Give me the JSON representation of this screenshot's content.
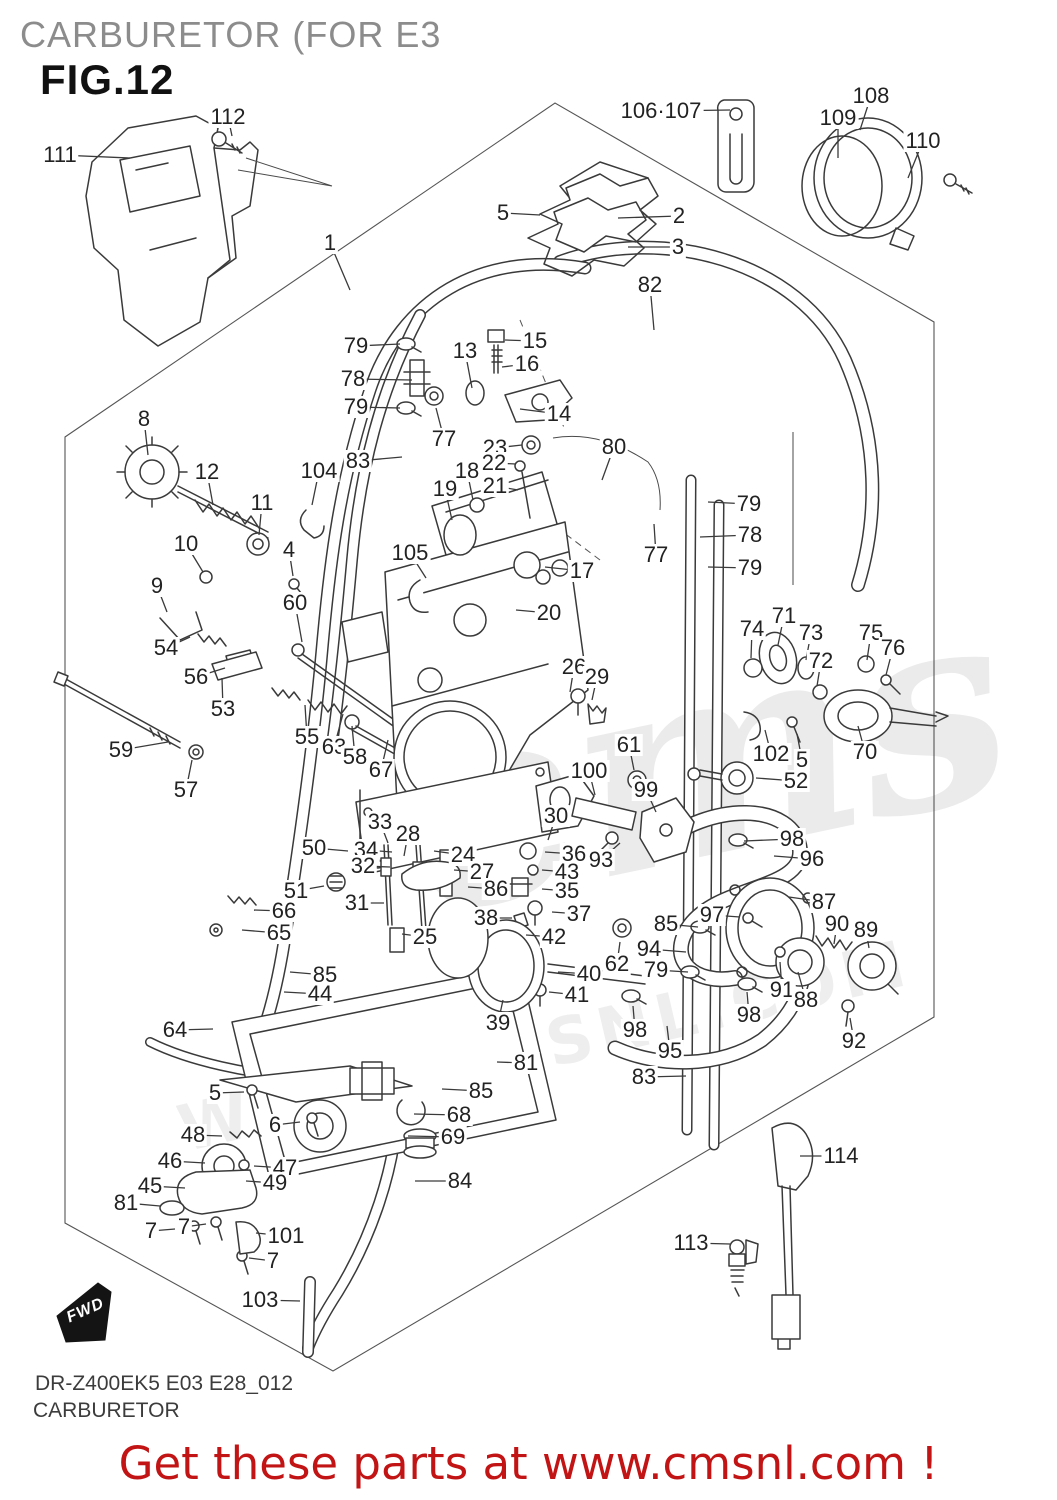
{
  "header": {
    "title": "CARBURETOR (FOR E3",
    "fig": "FIG.12"
  },
  "footer": {
    "model_code": "DR-Z400EK5 E03 E28_012",
    "sheet_name": "CARBURETOR",
    "promo": "Get these parts at www.cmsnl.com !"
  },
  "fwd": {
    "label": "FWD"
  },
  "watermark": {
    "logo": "ems",
    "url": "WWW.CMSNL.COM"
  },
  "colors": {
    "promo_red": "#c21414",
    "line": "#3a3a3a",
    "title_gray": "#8c8c8c"
  },
  "callouts": [
    {
      "n": "111",
      "x": 60,
      "y": 155,
      "lx": 130,
      "ly": 158
    },
    {
      "n": "112",
      "x": 228,
      "y": 117,
      "lx": 232,
      "ly": 136
    },
    {
      "n": "1",
      "x": 330,
      "y": 243,
      "lx": 350,
      "ly": 290
    },
    {
      "n": "5",
      "x": 503,
      "y": 213,
      "lx": 540,
      "ly": 215
    },
    {
      "n": "2",
      "x": 679,
      "y": 216,
      "lx": 618,
      "ly": 218
    },
    {
      "n": "3",
      "x": 678,
      "y": 247,
      "lx": 628,
      "ly": 247
    },
    {
      "n": "106·107",
      "x": 661,
      "y": 111,
      "lx": 730,
      "ly": 110
    },
    {
      "n": "108",
      "x": 871,
      "y": 96,
      "lx": 860,
      "ly": 130
    },
    {
      "n": "109",
      "x": 838,
      "y": 118,
      "lx": 838,
      "ly": 158
    },
    {
      "n": "110",
      "x": 923,
      "y": 141,
      "lx": 908,
      "ly": 178
    },
    {
      "n": "82",
      "x": 650,
      "y": 285,
      "lx": 654,
      "ly": 330
    },
    {
      "n": "79",
      "x": 356,
      "y": 346,
      "lx": 400,
      "ly": 344
    },
    {
      "n": "78",
      "x": 353,
      "y": 379,
      "lx": 412,
      "ly": 380
    },
    {
      "n": "79",
      "x": 356,
      "y": 407,
      "lx": 400,
      "ly": 408
    },
    {
      "n": "77",
      "x": 444,
      "y": 439,
      "lx": 436,
      "ly": 408
    },
    {
      "n": "13",
      "x": 465,
      "y": 351,
      "lx": 472,
      "ly": 388
    },
    {
      "n": "15",
      "x": 535,
      "y": 341,
      "lx": 505,
      "ly": 340
    },
    {
      "n": "16",
      "x": 527,
      "y": 364,
      "lx": 502,
      "ly": 367
    },
    {
      "n": "14",
      "x": 559,
      "y": 414,
      "lx": 520,
      "ly": 409
    },
    {
      "n": "83",
      "x": 358,
      "y": 461,
      "lx": 402,
      "ly": 457
    },
    {
      "n": "8",
      "x": 144,
      "y": 419,
      "lx": 148,
      "ly": 455
    },
    {
      "n": "12",
      "x": 207,
      "y": 472,
      "lx": 213,
      "ly": 505
    },
    {
      "n": "11",
      "x": 262,
      "y": 503,
      "lx": 259,
      "ly": 535
    },
    {
      "n": "104",
      "x": 319,
      "y": 471,
      "lx": 312,
      "ly": 505
    },
    {
      "n": "23",
      "x": 495,
      "y": 448,
      "lx": 522,
      "ly": 445
    },
    {
      "n": "22",
      "x": 494,
      "y": 463,
      "lx": 516,
      "ly": 464
    },
    {
      "n": "21",
      "x": 495,
      "y": 486,
      "lx": 518,
      "ly": 490
    },
    {
      "n": "18",
      "x": 467,
      "y": 471,
      "lx": 473,
      "ly": 500
    },
    {
      "n": "19",
      "x": 445,
      "y": 489,
      "lx": 452,
      "ly": 520
    },
    {
      "n": "80",
      "x": 614,
      "y": 447,
      "lx": 602,
      "ly": 480
    },
    {
      "n": "79",
      "x": 749,
      "y": 504,
      "lx": 708,
      "ly": 502
    },
    {
      "n": "78",
      "x": 750,
      "y": 535,
      "lx": 700,
      "ly": 537
    },
    {
      "n": "79",
      "x": 750,
      "y": 568,
      "lx": 708,
      "ly": 567
    },
    {
      "n": "77",
      "x": 656,
      "y": 555,
      "lx": 654,
      "ly": 524
    },
    {
      "n": "10",
      "x": 186,
      "y": 544,
      "lx": 203,
      "ly": 572
    },
    {
      "n": "4",
      "x": 289,
      "y": 550,
      "lx": 293,
      "ly": 576
    },
    {
      "n": "105",
      "x": 410,
      "y": 553,
      "lx": 426,
      "ly": 578
    },
    {
      "n": "9",
      "x": 157,
      "y": 586,
      "lx": 167,
      "ly": 612
    },
    {
      "n": "60",
      "x": 295,
      "y": 603,
      "lx": 302,
      "ly": 642
    },
    {
      "n": "17",
      "x": 582,
      "y": 571,
      "lx": 545,
      "ly": 567
    },
    {
      "n": "20",
      "x": 549,
      "y": 613,
      "lx": 516,
      "ly": 610
    },
    {
      "n": "54",
      "x": 166,
      "y": 648,
      "lx": 190,
      "ly": 637
    },
    {
      "n": "56",
      "x": 196,
      "y": 677,
      "lx": 225,
      "ly": 668
    },
    {
      "n": "53",
      "x": 223,
      "y": 709,
      "lx": 222,
      "ly": 678
    },
    {
      "n": "26",
      "x": 574,
      "y": 667,
      "lx": 570,
      "ly": 692
    },
    {
      "n": "29",
      "x": 597,
      "y": 677,
      "lx": 592,
      "ly": 700
    },
    {
      "n": "74",
      "x": 752,
      "y": 629,
      "lx": 751,
      "ly": 658
    },
    {
      "n": "71",
      "x": 784,
      "y": 616,
      "lx": 778,
      "ly": 645
    },
    {
      "n": "73",
      "x": 811,
      "y": 633,
      "lx": 806,
      "ly": 660
    },
    {
      "n": "72",
      "x": 821,
      "y": 661,
      "lx": 817,
      "ly": 686
    },
    {
      "n": "75",
      "x": 871,
      "y": 633,
      "lx": 867,
      "ly": 660
    },
    {
      "n": "76",
      "x": 893,
      "y": 648,
      "lx": 886,
      "ly": 675
    },
    {
      "n": "59",
      "x": 121,
      "y": 750,
      "lx": 168,
      "ly": 742
    },
    {
      "n": "57",
      "x": 186,
      "y": 790,
      "lx": 192,
      "ly": 760
    },
    {
      "n": "55",
      "x": 307,
      "y": 737,
      "lx": 305,
      "ly": 705
    },
    {
      "n": "63",
      "x": 334,
      "y": 747,
      "lx": 343,
      "ly": 714
    },
    {
      "n": "58",
      "x": 355,
      "y": 757,
      "lx": 352,
      "ly": 726
    },
    {
      "n": "67",
      "x": 381,
      "y": 770,
      "lx": 388,
      "ly": 740
    },
    {
      "n": "61",
      "x": 629,
      "y": 745,
      "lx": 634,
      "ly": 770
    },
    {
      "n": "100",
      "x": 589,
      "y": 771,
      "lx": 595,
      "ly": 795
    },
    {
      "n": "99",
      "x": 646,
      "y": 790,
      "lx": 656,
      "ly": 812
    },
    {
      "n": "102",
      "x": 771,
      "y": 754,
      "lx": 765,
      "ly": 730
    },
    {
      "n": "5",
      "x": 802,
      "y": 760,
      "lx": 797,
      "ly": 734
    },
    {
      "n": "70",
      "x": 865,
      "y": 752,
      "lx": 858,
      "ly": 726
    },
    {
      "n": "52",
      "x": 796,
      "y": 781,
      "lx": 756,
      "ly": 778
    },
    {
      "n": "33",
      "x": 380,
      "y": 822,
      "lx": 388,
      "ly": 843
    },
    {
      "n": "28",
      "x": 408,
      "y": 834,
      "lx": 404,
      "ly": 856
    },
    {
      "n": "34",
      "x": 366,
      "y": 850,
      "lx": 392,
      "ly": 852
    },
    {
      "n": "32",
      "x": 363,
      "y": 866,
      "lx": 390,
      "ly": 867
    },
    {
      "n": "50",
      "x": 314,
      "y": 848,
      "lx": 348,
      "ly": 851
    },
    {
      "n": "24",
      "x": 463,
      "y": 855,
      "lx": 434,
      "ly": 851
    },
    {
      "n": "27",
      "x": 482,
      "y": 872,
      "lx": 454,
      "ly": 870
    },
    {
      "n": "86",
      "x": 496,
      "y": 889,
      "lx": 468,
      "ly": 887
    },
    {
      "n": "30",
      "x": 556,
      "y": 816,
      "lx": 548,
      "ly": 840
    },
    {
      "n": "36",
      "x": 574,
      "y": 854,
      "lx": 545,
      "ly": 852
    },
    {
      "n": "43",
      "x": 567,
      "y": 872,
      "lx": 542,
      "ly": 870
    },
    {
      "n": "35",
      "x": 567,
      "y": 891,
      "lx": 542,
      "ly": 889
    },
    {
      "n": "37",
      "x": 579,
      "y": 914,
      "lx": 552,
      "ly": 912
    },
    {
      "n": "38",
      "x": 486,
      "y": 918,
      "lx": 512,
      "ly": 918
    },
    {
      "n": "42",
      "x": 554,
      "y": 937,
      "lx": 526,
      "ly": 935
    },
    {
      "n": "25",
      "x": 425,
      "y": 937,
      "lx": 402,
      "ly": 934
    },
    {
      "n": "51",
      "x": 296,
      "y": 891,
      "lx": 324,
      "ly": 886
    },
    {
      "n": "31",
      "x": 357,
      "y": 903,
      "lx": 384,
      "ly": 903
    },
    {
      "n": "66",
      "x": 284,
      "y": 911,
      "lx": 254,
      "ly": 910
    },
    {
      "n": "65",
      "x": 279,
      "y": 933,
      "lx": 242,
      "ly": 930
    },
    {
      "n": "93",
      "x": 601,
      "y": 860,
      "lx": 620,
      "ly": 843
    },
    {
      "n": "98",
      "x": 792,
      "y": 839,
      "lx": 744,
      "ly": 841
    },
    {
      "n": "96",
      "x": 812,
      "y": 859,
      "lx": 774,
      "ly": 856
    },
    {
      "n": "87",
      "x": 824,
      "y": 902,
      "lx": 789,
      "ly": 897
    },
    {
      "n": "90",
      "x": 837,
      "y": 924,
      "lx": 834,
      "ly": 944
    },
    {
      "n": "89",
      "x": 866,
      "y": 930,
      "lx": 869,
      "ly": 948
    },
    {
      "n": "85",
      "x": 666,
      "y": 924,
      "lx": 698,
      "ly": 927
    },
    {
      "n": "97",
      "x": 712,
      "y": 915,
      "lx": 740,
      "ly": 917
    },
    {
      "n": "94",
      "x": 649,
      "y": 949,
      "lx": 686,
      "ly": 952
    },
    {
      "n": "79",
      "x": 656,
      "y": 970,
      "lx": 688,
      "ly": 972
    },
    {
      "n": "62",
      "x": 617,
      "y": 964,
      "lx": 620,
      "ly": 942
    },
    {
      "n": "40",
      "x": 589,
      "y": 974,
      "lx": 558,
      "ly": 972
    },
    {
      "n": "41",
      "x": 577,
      "y": 995,
      "lx": 549,
      "ly": 992
    },
    {
      "n": "91",
      "x": 782,
      "y": 990,
      "lx": 780,
      "ly": 962
    },
    {
      "n": "88",
      "x": 806,
      "y": 1000,
      "lx": 798,
      "ly": 972
    },
    {
      "n": "39",
      "x": 498,
      "y": 1023,
      "lx": 503,
      "ly": 1000
    },
    {
      "n": "85",
      "x": 325,
      "y": 975,
      "lx": 290,
      "ly": 972
    },
    {
      "n": "44",
      "x": 320,
      "y": 994,
      "lx": 284,
      "ly": 992
    },
    {
      "n": "98",
      "x": 749,
      "y": 1015,
      "lx": 747,
      "ly": 992
    },
    {
      "n": "98",
      "x": 635,
      "y": 1030,
      "lx": 633,
      "ly": 1006
    },
    {
      "n": "95",
      "x": 670,
      "y": 1051,
      "lx": 667,
      "ly": 1026
    },
    {
      "n": "92",
      "x": 854,
      "y": 1041,
      "lx": 850,
      "ly": 1018
    },
    {
      "n": "83",
      "x": 644,
      "y": 1077,
      "lx": 686,
      "ly": 1076
    },
    {
      "n": "64",
      "x": 175,
      "y": 1030,
      "lx": 213,
      "ly": 1029
    },
    {
      "n": "81",
      "x": 526,
      "y": 1063,
      "lx": 497,
      "ly": 1062
    },
    {
      "n": "85",
      "x": 481,
      "y": 1091,
      "lx": 442,
      "ly": 1089
    },
    {
      "n": "5",
      "x": 215,
      "y": 1093,
      "lx": 244,
      "ly": 1092
    },
    {
      "n": "6",
      "x": 275,
      "y": 1125,
      "lx": 300,
      "ly": 1122
    },
    {
      "n": "48",
      "x": 193,
      "y": 1135,
      "lx": 222,
      "ly": 1136
    },
    {
      "n": "46",
      "x": 170,
      "y": 1161,
      "lx": 205,
      "ly": 1163
    },
    {
      "n": "47",
      "x": 285,
      "y": 1168,
      "lx": 254,
      "ly": 1166
    },
    {
      "n": "49",
      "x": 275,
      "y": 1183,
      "lx": 246,
      "ly": 1181
    },
    {
      "n": "45",
      "x": 150,
      "y": 1186,
      "lx": 185,
      "ly": 1188
    },
    {
      "n": "81",
      "x": 126,
      "y": 1203,
      "lx": 160,
      "ly": 1206
    },
    {
      "n": "7",
      "x": 151,
      "y": 1231,
      "lx": 175,
      "ly": 1229
    },
    {
      "n": "7",
      "x": 184,
      "y": 1227,
      "lx": 206,
      "ly": 1224
    },
    {
      "n": "101",
      "x": 286,
      "y": 1236,
      "lx": 256,
      "ly": 1233
    },
    {
      "n": "7",
      "x": 273,
      "y": 1261,
      "lx": 249,
      "ly": 1258
    },
    {
      "n": "103",
      "x": 260,
      "y": 1300,
      "lx": 300,
      "ly": 1301
    },
    {
      "n": "68",
      "x": 459,
      "y": 1115,
      "lx": 414,
      "ly": 1114
    },
    {
      "n": "69",
      "x": 453,
      "y": 1137,
      "lx": 408,
      "ly": 1136
    },
    {
      "n": "84",
      "x": 460,
      "y": 1181,
      "lx": 415,
      "ly": 1181
    },
    {
      "n": "114",
      "x": 841,
      "y": 1156,
      "lx": 800,
      "ly": 1156
    },
    {
      "n": "113",
      "x": 691,
      "y": 1243,
      "lx": 730,
      "ly": 1244
    }
  ]
}
